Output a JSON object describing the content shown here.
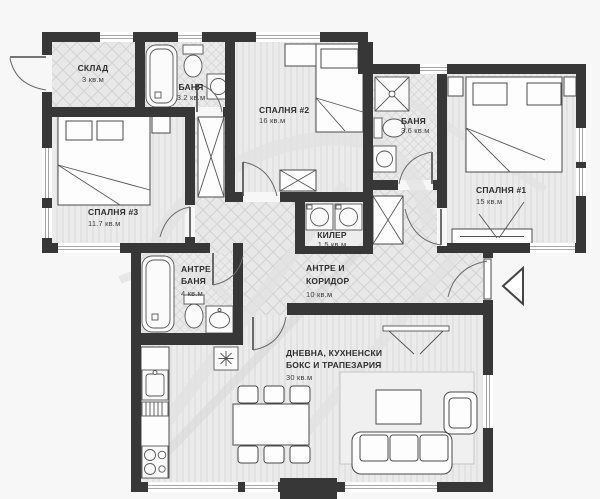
{
  "plan": {
    "type": "apartment-floor-plan",
    "colors": {
      "background": "#f7f7f7",
      "walls": "#373737",
      "floor_hatch_bg": "#ebebeb",
      "floor_hatch_line": "#d6d6d6",
      "furniture_outline": "#4a4a4a",
      "label_text": "#2e2e2e"
    },
    "rooms": [
      {
        "id": "storage",
        "label": "СКЛАД",
        "area": "3 кв.м"
      },
      {
        "id": "bathroom-top",
        "label": "БАНЯ",
        "area": "3.2 кв.м"
      },
      {
        "id": "bedroom-2",
        "label": "СПАЛНЯ #2",
        "area": "16 кв.м"
      },
      {
        "id": "bathroom-right",
        "label": "БАНЯ",
        "area": "3.6 кв.м"
      },
      {
        "id": "bedroom-1",
        "label": "СПАЛНЯ #1",
        "area": "15 кв.м"
      },
      {
        "id": "bedroom-3",
        "label": "СПАЛНЯ #3",
        "area": "11.7 кв.м"
      },
      {
        "id": "pantry",
        "label": "КИЛЕР",
        "area": "1.5 кв.м"
      },
      {
        "id": "hall-bathroom",
        "label_line1": "АНТРЕ",
        "label_line2": "БАНЯ",
        "area": "4 кв.м"
      },
      {
        "id": "hall-corridor",
        "label_line1": "АНТРЕ И",
        "label_line2": "КОРИДОР",
        "area": "10 кв.м"
      },
      {
        "id": "living-kitchen",
        "label_line1": "ДНЕВНА, КУХНЕНСКИ",
        "label_line2": "БОКС И ТРАПЕЗАРИЯ",
        "area": "30 кв.м"
      }
    ]
  }
}
